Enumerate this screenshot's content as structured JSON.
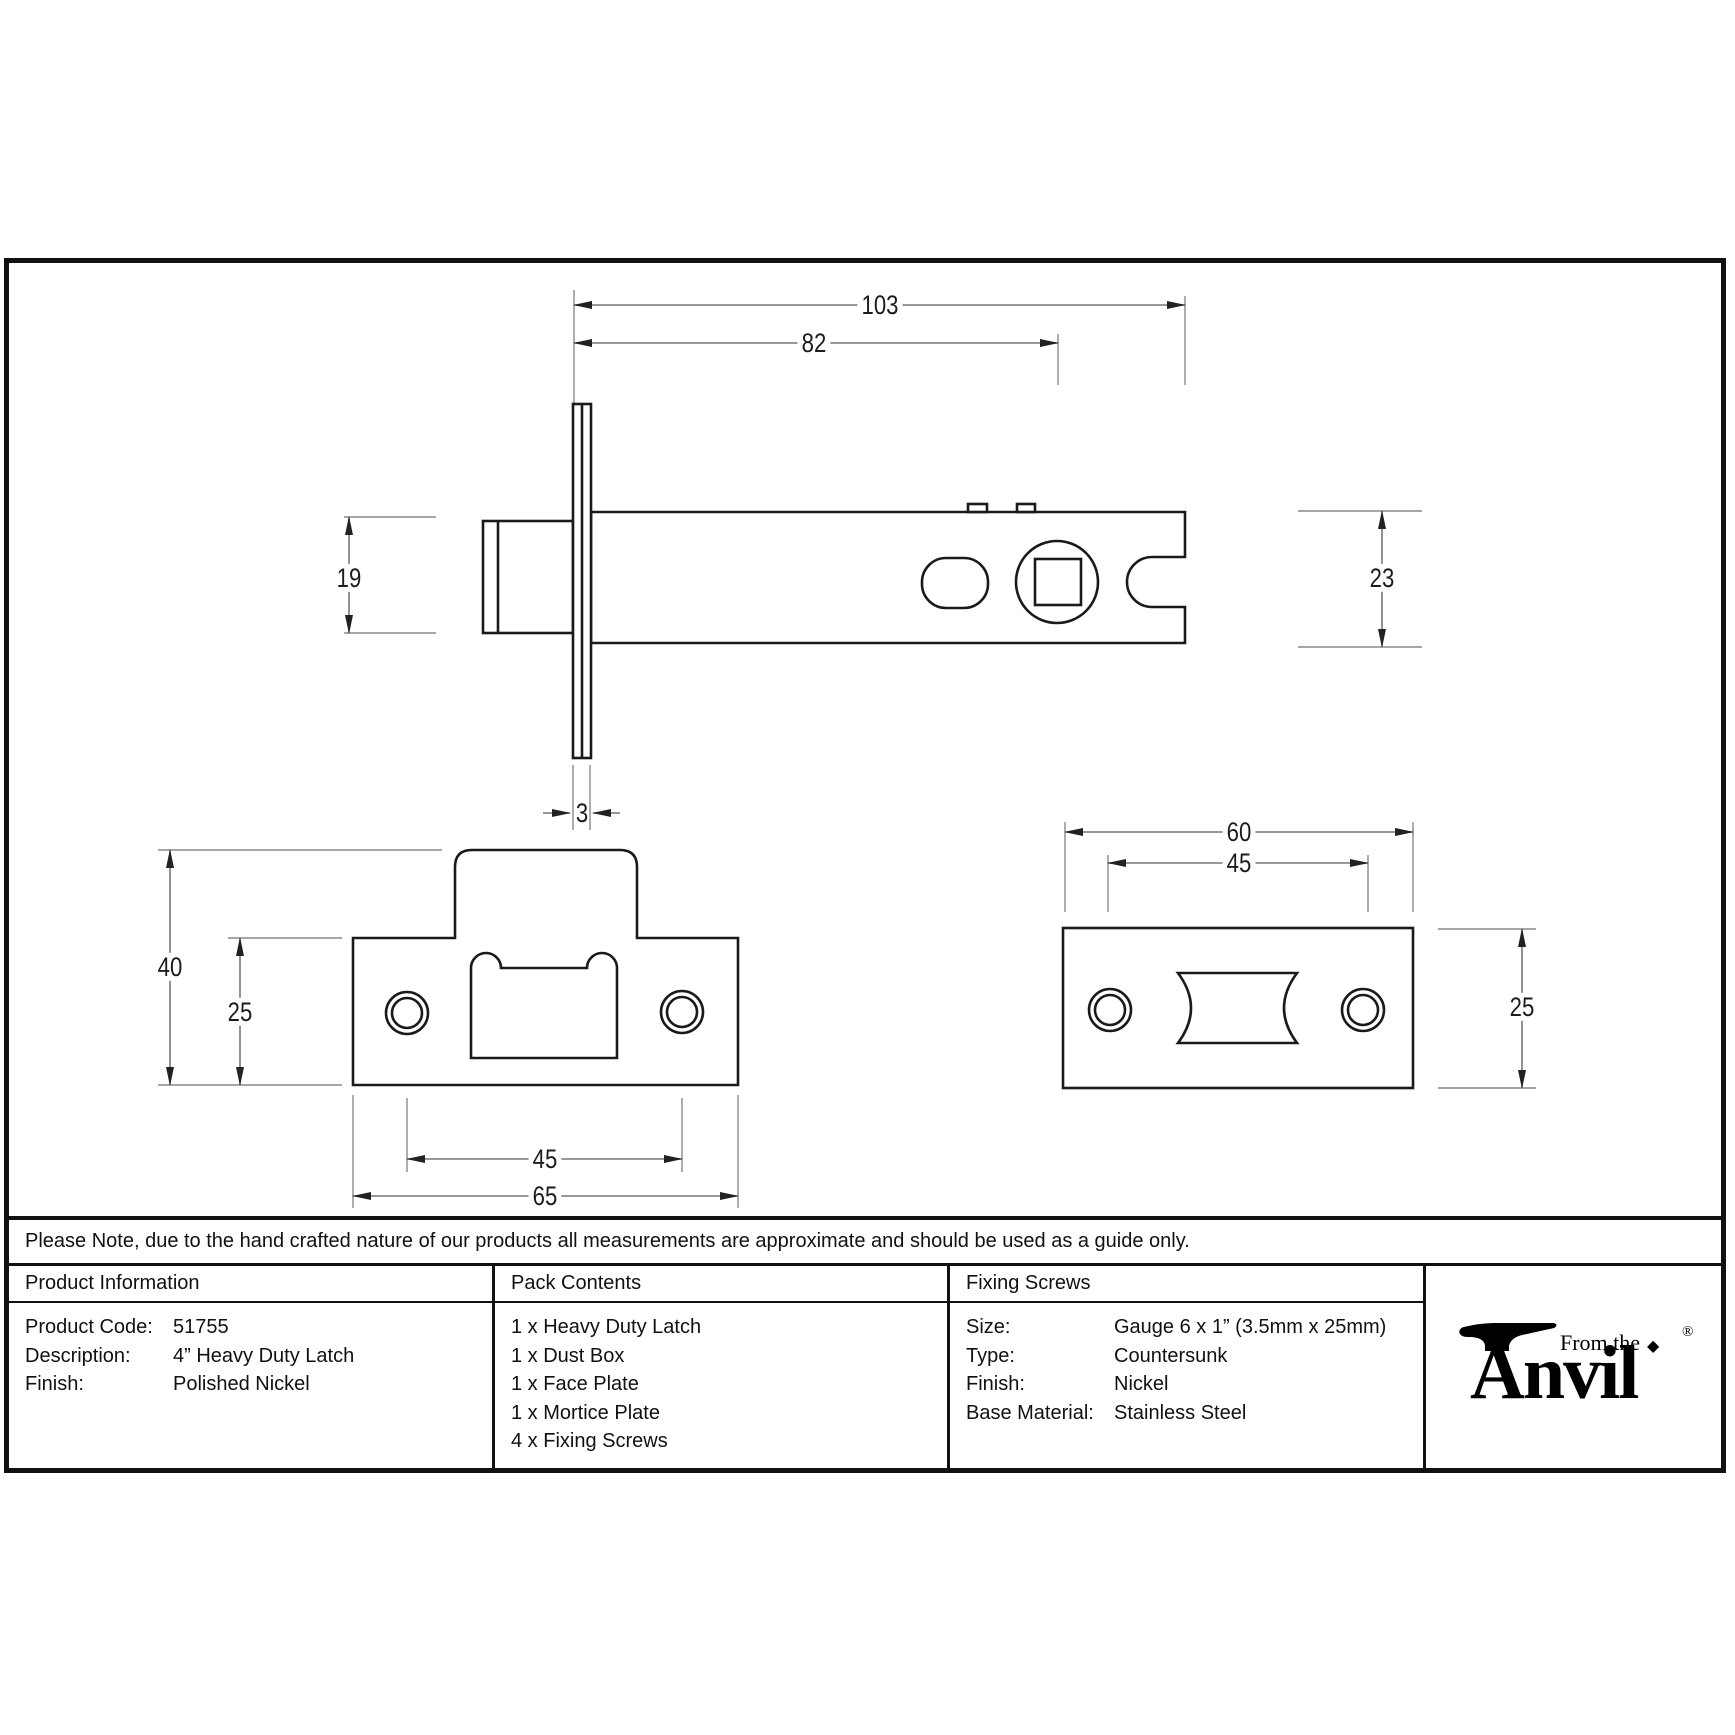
{
  "dimensions": {
    "side_view": {
      "overall_length": "103",
      "backset": "82",
      "bolt_height": "19",
      "case_height": "23",
      "faceplate_thickness": "3"
    },
    "face_plate_view": {
      "overall_height": "40",
      "plate_height": "25",
      "hole_spacing": "45",
      "plate_width": "65"
    },
    "mortice_plate_view": {
      "plate_width": "60",
      "hole_spacing": "45",
      "plate_height": "25"
    }
  },
  "note": "Please Note, due to the hand crafted nature of our products all measurements are approximate and should be used as a guide only.",
  "table": {
    "product_information": {
      "header": "Product Information",
      "rows": [
        {
          "label": "Product Code:",
          "value": "51755"
        },
        {
          "label": "Description:",
          "value": "4” Heavy Duty Latch"
        },
        {
          "label": "Finish:",
          "value": "Polished Nickel"
        }
      ]
    },
    "pack_contents": {
      "header": "Pack Contents",
      "items": [
        "1 x Heavy Duty Latch",
        "1 x Dust Box",
        "1 x Face Plate",
        "1 x Mortice Plate",
        "4 x Fixing Screws"
      ]
    },
    "fixing_screws": {
      "header": "Fixing Screws",
      "rows": [
        {
          "label": "Size:",
          "value": "Gauge 6 x 1” (3.5mm x 25mm)"
        },
        {
          "label": "Type:",
          "value": "Countersunk"
        },
        {
          "label": "Finish:",
          "value": "Nickel"
        },
        {
          "label": "Base Material:",
          "value": "Stainless Steel"
        }
      ]
    }
  },
  "logo": {
    "from_the": "From the",
    "brand": "Anvil",
    "registered": "®",
    "diamond": "◆"
  },
  "colors": {
    "line": "#1a1a1a",
    "dim_line": "#777777",
    "background": "#ffffff"
  }
}
